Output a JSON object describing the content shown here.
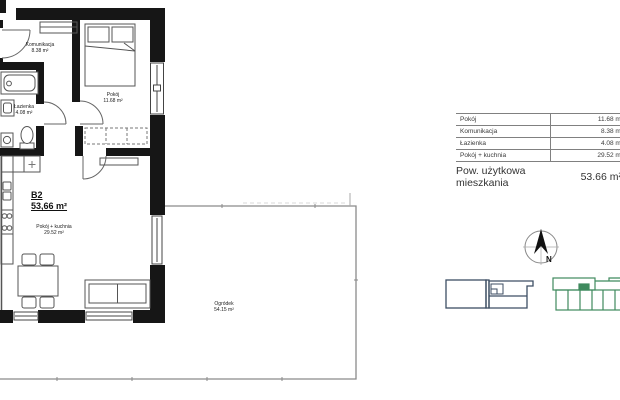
{
  "floor_plan": {
    "unit_label": "B2",
    "unit_area": "53,66 m²",
    "rooms": [
      {
        "name": "Komunikacja",
        "area": "8.38 m²"
      },
      {
        "name": "Pokój",
        "area": "11.68 m²"
      },
      {
        "name": "Łazienka",
        "area": "4.08 m²"
      },
      {
        "name": "Pokój + kuchnia",
        "area": "29.52 m²"
      },
      {
        "name": "Ogródek",
        "area": "54.15 m²"
      }
    ]
  },
  "area_table": {
    "rows": [
      {
        "label": "Pokój",
        "value": "11.68 m²"
      },
      {
        "label": "Komunikacja",
        "value": "8.38 m²"
      },
      {
        "label": "Łazienka",
        "value": "4.08 m²"
      },
      {
        "label": "Pokój + kuchnia",
        "value": "29.52 m²"
      }
    ],
    "summary": {
      "label": "Pow. użytkowa mieszkania",
      "value": "53.66 m²"
    }
  },
  "compass": {
    "north_label": "N"
  },
  "colors": {
    "wall": "#161616",
    "garden_line": "#8a8a8a",
    "navy_building": "#3d4e63",
    "green_building": "#3f8a5e"
  }
}
